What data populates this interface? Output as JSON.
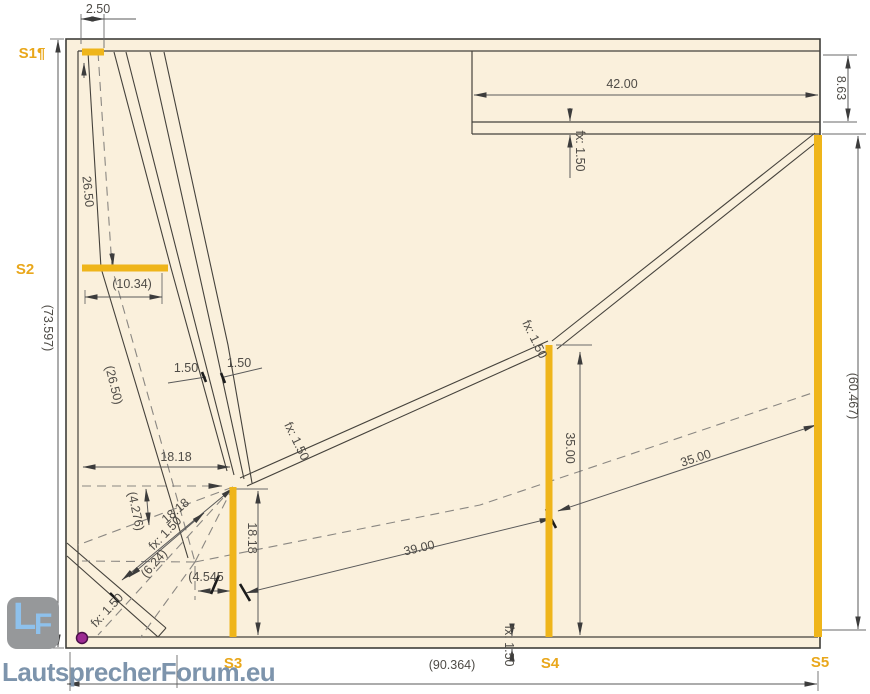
{
  "drawing": {
    "colors": {
      "panel_fill": "#faf0dc",
      "line": "#3f3e3a",
      "dimension": "#5a5a5a",
      "dashed": "#8a8782",
      "accent_yellow": "#efb51a",
      "station_label_orange": "#e9a71b",
      "origin_marker_magenta": "#9c2a92",
      "logo_blue": "#8ec1ec",
      "logo_background": "#96989a",
      "watermark_text": "#7d94ac"
    }
  },
  "stations": [
    {
      "id": "S1",
      "label": "S1¶",
      "x": 32,
      "y": 58
    },
    {
      "id": "S2",
      "label": "S2",
      "x": 25,
      "y": 274
    },
    {
      "id": "S3",
      "label": "S3",
      "x": 233,
      "y": 668
    },
    {
      "id": "S4",
      "label": "S4",
      "x": 550,
      "y": 668
    },
    {
      "id": "S5",
      "label": "S5",
      "x": 820,
      "y": 667
    }
  ],
  "dimensions": [
    {
      "label": "2.50",
      "x": 98,
      "y": 13,
      "rot": 0
    },
    {
      "label": "26.50",
      "x": 84,
      "y": 192,
      "rot": 84
    },
    {
      "label": "(73.597)",
      "x": 44,
      "y": 328,
      "rot": 90
    },
    {
      "label": "(10.34)",
      "x": 132,
      "y": 288,
      "rot": 0
    },
    {
      "label": "(26.50)",
      "x": 110,
      "y": 386,
      "rot": 76
    },
    {
      "label": "1.50",
      "x": 186,
      "y": 372,
      "rot": 0
    },
    {
      "label": "1.50",
      "x": 239,
      "y": 367,
      "rot": 0
    },
    {
      "label": "42.00",
      "x": 622,
      "y": 88,
      "rot": 0
    },
    {
      "label": "8.63",
      "x": 837,
      "y": 88,
      "rot": 90
    },
    {
      "label": "fx: 1.50",
      "x": 576,
      "y": 151,
      "rot": 90
    },
    {
      "label": "(60.467)",
      "x": 849,
      "y": 396,
      "rot": 90
    },
    {
      "label": "fx: 1.50",
      "x": 293,
      "y": 443,
      "rot": 64
    },
    {
      "label": "fx: 1.50",
      "x": 531,
      "y": 341,
      "rot": 64
    },
    {
      "label": "18.18",
      "x": 176,
      "y": 461,
      "rot": 0
    },
    {
      "label": "(4.276)",
      "x": 132,
      "y": 512,
      "rot": 78
    },
    {
      "label": "18.18",
      "x": 178,
      "y": 514,
      "rot": -40
    },
    {
      "label": "(6.24)",
      "x": 157,
      "y": 566,
      "rot": -49
    },
    {
      "label": "fx: 1.50",
      "x": 168,
      "y": 536,
      "rot": -46
    },
    {
      "label": "(4.545",
      "x": 206,
      "y": 581,
      "rot": 0
    },
    {
      "label": "18.18",
      "x": 248,
      "y": 538,
      "rot": 90
    },
    {
      "label": "39.00",
      "x": 420,
      "y": 552,
      "rot": -13
    },
    {
      "label": "35.00",
      "x": 566,
      "y": 448,
      "rot": 90
    },
    {
      "label": "35.00",
      "x": 697,
      "y": 462,
      "rot": -18
    },
    {
      "label": "fx: 1.50",
      "x": 505,
      "y": 646,
      "rot": 90
    },
    {
      "label": "(90.364)",
      "x": 452,
      "y": 669,
      "rot": 0
    },
    {
      "label": "fx: 1.50",
      "x": 110,
      "y": 613,
      "rot": -47
    }
  ],
  "logo": {
    "monogram_l": "L",
    "monogram_f": "F",
    "site": "LautsprecherForum.eu"
  }
}
